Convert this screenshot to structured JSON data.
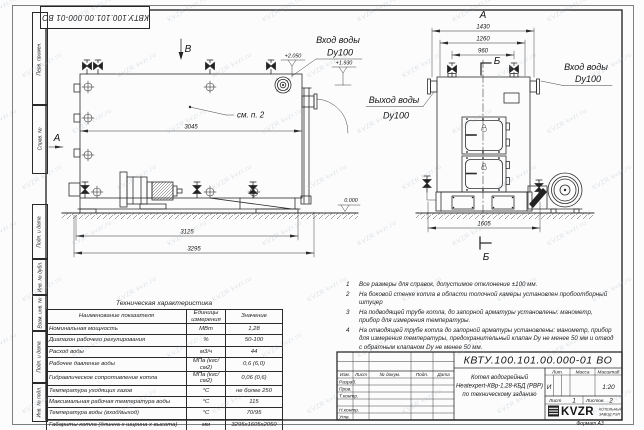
{
  "watermark": {
    "text": "KVZR kvzr.ru"
  },
  "frame": {
    "stamp_rotated": "КВТУ.100.101.00.000-01 ВО",
    "left_labels": [
      "Перв. примен.",
      "Справ. №",
      "Подп. и дата",
      "Инв. № дубл.",
      "Взам. инв. №",
      "Подп. и дата",
      "Инв. № подл."
    ],
    "format_label": "Формат А3"
  },
  "views": {
    "front": {
      "view_arrow_top": "В",
      "view_arrow_left": "А",
      "callout": "см. п. 2",
      "inlet_label": "Вход воды",
      "inlet_dn": "Dy100",
      "level_top": "+2.050",
      "level_pipe": "+1.930",
      "level_zero": "0.000",
      "dim_body": "3045",
      "dim_frame": "3125",
      "dim_overall": "3295"
    },
    "side": {
      "view_title": "А",
      "section_top": "Б",
      "section_bottom": "Б",
      "dim_width_overall": "1430",
      "dim_width_mid": "1260",
      "dim_width_valves": "960",
      "dim_base": "1605",
      "inlet_label": "Вход воды",
      "inlet_dn": "Dy100",
      "outlet_label": "Выход воды",
      "outlet_dn": "Dy100"
    }
  },
  "notes": [
    {
      "num": "1",
      "text": "Все размеры для справок, допустимое отклонение ±100 мм."
    },
    {
      "num": "2",
      "text": "На боковой стенке котла в области топочной камеры установлен пробоотборный штуцер"
    },
    {
      "num": "3",
      "text": "На подводящей трубе котла, до запорной арматуры установлены: манометр, прибор для измерения температуры."
    },
    {
      "num": "4",
      "text": "На отводящей трубе котла до запорной арматуры установлены: манометр, прибор для измерения температуры, предохранительный клапан Dу не менее 50 мм и отвод с обратным клапаном Dу не менее 50 мм."
    }
  ],
  "spec_table": {
    "title": "Техническая характеристика",
    "headers": [
      "Наименование показателя",
      "Единицы измерения",
      "Значение"
    ],
    "rows": [
      {
        "name": "Номинальная мощность",
        "unit": "МВт",
        "value": "1,28"
      },
      {
        "name": "Диапазон рабочего регулирования",
        "unit": "%",
        "value": "50-100"
      },
      {
        "name": "Расход воды",
        "unit": "м3/ч",
        "value": "44"
      },
      {
        "name": "Рабочее давление воды",
        "unit": "МПа (кгс/см2)",
        "value": "0,6 (6,0)"
      },
      {
        "name": "Гидравлическое сопротивление котла",
        "unit": "МПа (кгс/см2)",
        "value": "0,06 (0,6)"
      },
      {
        "name": "Температура уходящих газов",
        "unit": "°С",
        "value": "не более 250"
      },
      {
        "name": "Максимальная рабочая температура воды",
        "unit": "°С",
        "value": "115"
      },
      {
        "name": "Температура воды (вход/выход)",
        "unit": "°С",
        "value": "70/95"
      },
      {
        "name": "Габариты котла (длинна х ширина х высота)",
        "unit": "мм",
        "value": "3295х1605х2050"
      }
    ]
  },
  "title_block": {
    "designation": "КВТУ.100.101.00.000-01 ВО",
    "name_line1": "Котел водогрейный",
    "name_line2": "Heatexpert-КВр-1,28-КБД (РВР)",
    "name_line3": "по техническому заданию",
    "lit_header": "Лит.",
    "mass_header": "Масса",
    "scale_header": "Масштаб",
    "lit_value": "И",
    "scale_value": "1:20",
    "sheet_label": "Лист",
    "sheet_value": "1",
    "sheets_label": "Листов",
    "sheets_value": "2",
    "rev_headers": [
      "Изм.",
      "Лист",
      "№ докум.",
      "Подп.",
      "Дата"
    ],
    "sig_labels": [
      "Разраб.",
      "Пров.",
      "Т.контр.",
      "Н.контр.",
      "Утв."
    ],
    "logo_text": "KVZR",
    "logo_sub1": "КОТЕЛЬНЫЙ",
    "logo_sub2": "ЗАВОД РЭП"
  }
}
